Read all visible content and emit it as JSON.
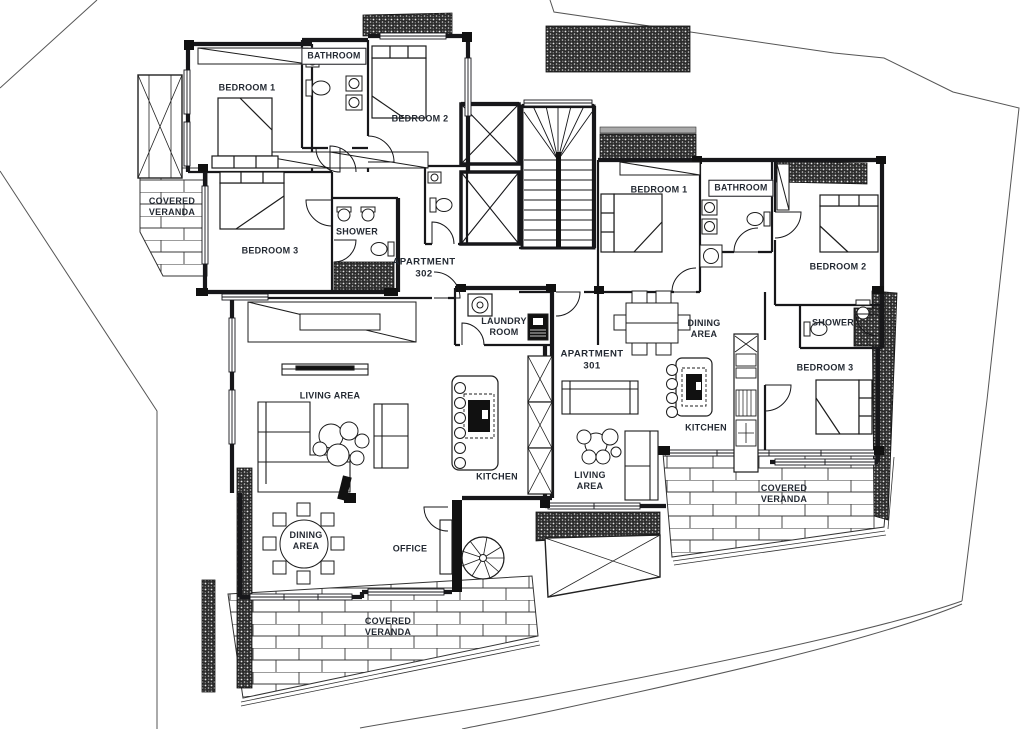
{
  "page": {
    "background": "#ffffff",
    "ink_color": "#17171a",
    "label_color": "#242a33",
    "boundary_color": "#555555"
  },
  "apartments": [
    {
      "id": "302",
      "label": "APARTMENT\n302"
    },
    {
      "id": "301",
      "label": "APARTMENT\n301"
    }
  ],
  "labels": [
    {
      "id": "bedroom1-302",
      "text": "BEDROOM 1",
      "x": 247,
      "y": 88,
      "boxed": false
    },
    {
      "id": "bathroom-302",
      "text": "BATHROOM",
      "x": 334,
      "y": 56,
      "boxed": true
    },
    {
      "id": "bedroom2-302",
      "text": "BEDROOM 2",
      "x": 420,
      "y": 119,
      "boxed": false
    },
    {
      "id": "veranda-west-302",
      "text": "COVERED\nVERANDA",
      "x": 172,
      "y": 207,
      "boxed": false
    },
    {
      "id": "bedroom3-302",
      "text": "BEDROOM 3",
      "x": 270,
      "y": 251,
      "boxed": false
    },
    {
      "id": "shower-302",
      "text": "SHOWER",
      "x": 357,
      "y": 232,
      "boxed": false
    },
    {
      "id": "apartment-302",
      "text": "APARTMENT\n302",
      "x": 424,
      "y": 268,
      "boxed": false
    },
    {
      "id": "laundry-room",
      "text": "LAUNDRY\nROOM",
      "x": 504,
      "y": 327,
      "boxed": false
    },
    {
      "id": "living-area-302",
      "text": "LIVING AREA",
      "x": 330,
      "y": 396,
      "boxed": false
    },
    {
      "id": "dining-area-302",
      "text": "DINING\nAREA",
      "x": 306,
      "y": 541,
      "boxed": false
    },
    {
      "id": "office",
      "text": "OFFICE",
      "x": 410,
      "y": 549,
      "boxed": false
    },
    {
      "id": "kitchen-302",
      "text": "KITCHEN",
      "x": 497,
      "y": 477,
      "boxed": false
    },
    {
      "id": "veranda-south-302",
      "text": "COVERED\nVERANDA",
      "x": 388,
      "y": 627,
      "boxed": false
    },
    {
      "id": "apartment-301",
      "text": "APARTMENT\n301",
      "x": 592,
      "y": 360,
      "boxed": false
    },
    {
      "id": "bedroom1-301",
      "text": "BEDROOM 1",
      "x": 659,
      "y": 190,
      "boxed": false
    },
    {
      "id": "bathroom-301",
      "text": "BATHROOM",
      "x": 741,
      "y": 188,
      "boxed": true
    },
    {
      "id": "bedroom2-301",
      "text": "BEDROOM 2",
      "x": 838,
      "y": 267,
      "boxed": false
    },
    {
      "id": "shower-301",
      "text": "SHOWER",
      "x": 833,
      "y": 323,
      "boxed": false
    },
    {
      "id": "bedroom3-301",
      "text": "BEDROOM 3",
      "x": 825,
      "y": 368,
      "boxed": false
    },
    {
      "id": "dining-area-301",
      "text": "DINING\nAREA",
      "x": 704,
      "y": 329,
      "boxed": false
    },
    {
      "id": "kitchen-301",
      "text": "KITCHEN",
      "x": 706,
      "y": 428,
      "boxed": false
    },
    {
      "id": "living-area-301",
      "text": "LIVING\nAREA",
      "x": 590,
      "y": 481,
      "boxed": false
    },
    {
      "id": "veranda-east-301",
      "text": "COVERED\nVERANDA",
      "x": 784,
      "y": 494,
      "boxed": false
    }
  ]
}
